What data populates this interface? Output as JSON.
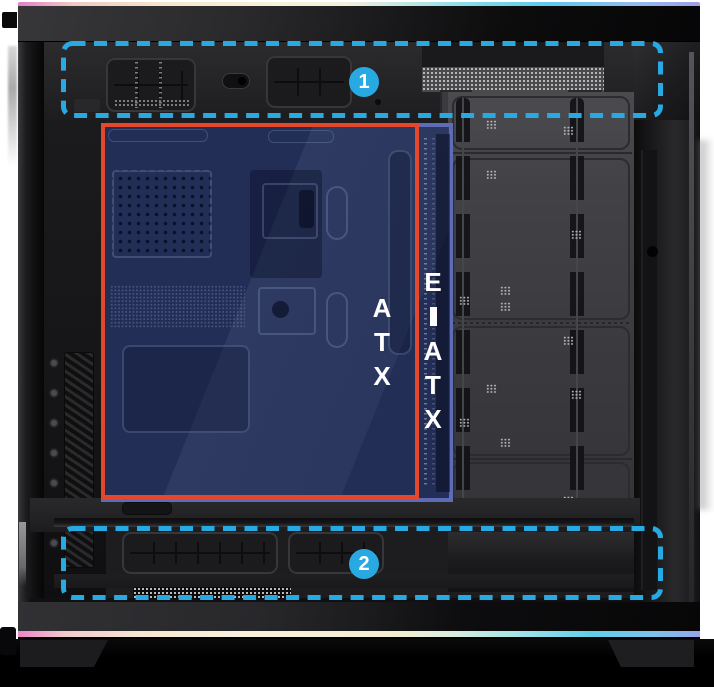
{
  "diagram": {
    "background_color": "#ffffff",
    "accent_colors": {
      "callout_outline": "#29A9E2",
      "atx_border": "#E5472D",
      "eatx_border": "#5E6CB8",
      "zone_fill": "rgba(36,49,96,0.88)",
      "rgb_strip_top": [
        "#e180c6",
        "#f5e7cb",
        "#7ed7ea",
        "#9f9ee9"
      ],
      "rgb_strip_bottom": [
        "#ee85c9",
        "#f8f1dd",
        "#5fd0e9",
        "#96a5e9"
      ]
    }
  },
  "annotations": {
    "regions": [
      {
        "number": "1"
      },
      {
        "number": "2"
      }
    ]
  },
  "zones": [
    {
      "label": "ATX",
      "border_color": "#E5472D",
      "text_color": "#ffffff"
    },
    {
      "label": "E-ATX",
      "border_color": "#5E6CB8",
      "text_color": "#ffffff"
    }
  ]
}
